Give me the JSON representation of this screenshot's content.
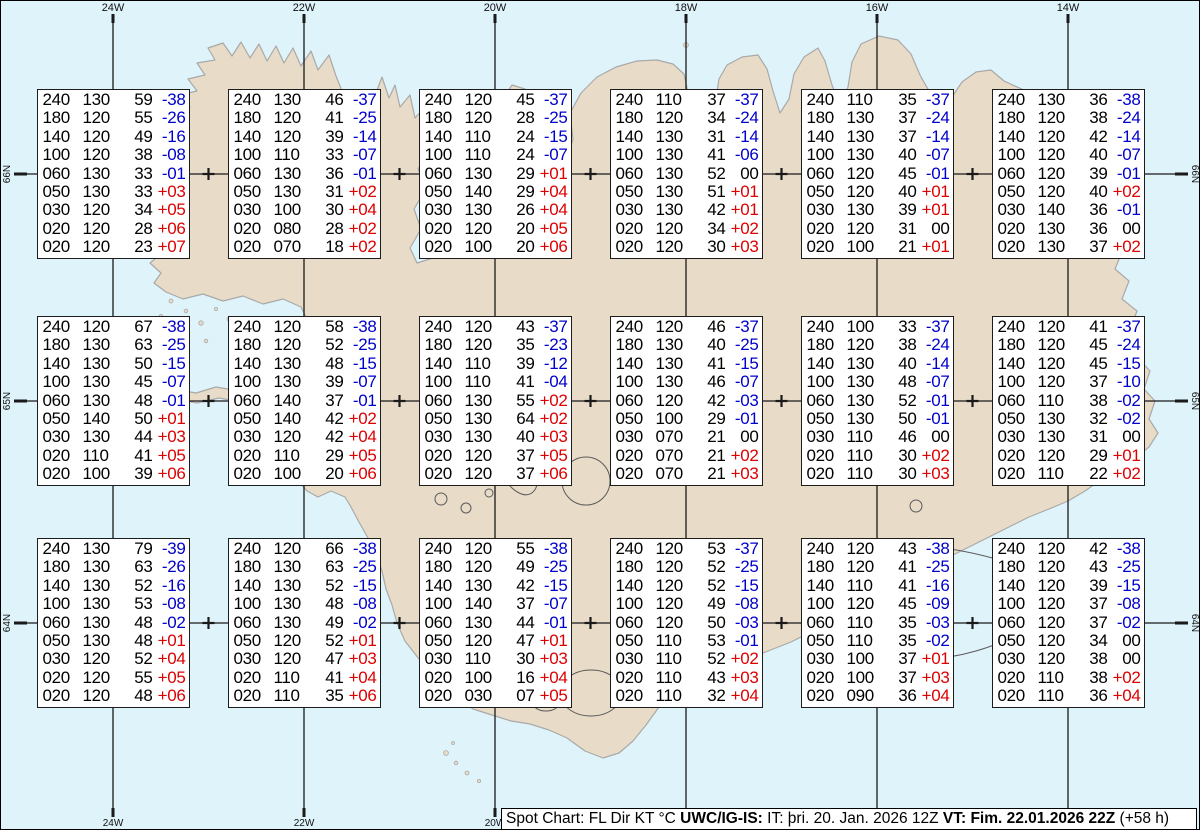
{
  "map": {
    "lon_labels": [
      "24W",
      "22W",
      "20W",
      "18W",
      "16W",
      "14W"
    ],
    "lat_labels": [
      "66N",
      "65N",
      "64N"
    ]
  },
  "colors": {
    "ocean": "#dff3fa",
    "land": "#e8dcc8",
    "coastline": "#a9a9a9",
    "contour": "#5a5a5a",
    "grid": "#1a1a1a",
    "temp_negative": "#0000cc",
    "temp_positive": "#dd0000",
    "temp_zero": "#000000"
  },
  "legend": {
    "segments": [
      {
        "text": "Spot Chart: FL Dir KT °C ",
        "bold": false
      },
      {
        "text": "UWC/IG-IS:",
        "bold": true
      },
      {
        "text": " IT: þri. 20. Jan. 2026 12Z ",
        "bold": false
      },
      {
        "text": "VT: Fim. 22.01.2026 22Z",
        "bold": true
      },
      {
        "text": " (+58 h)",
        "bold": false
      }
    ]
  },
  "stations": [
    {
      "id": "r1c1",
      "rows": [
        [
          "240",
          "130",
          "59",
          "-38"
        ],
        [
          "180",
          "120",
          "55",
          "-26"
        ],
        [
          "140",
          "120",
          "49",
          "-16"
        ],
        [
          "100",
          "120",
          "38",
          "-08"
        ],
        [
          "060",
          "130",
          "33",
          "-01"
        ],
        [
          "050",
          "130",
          "33",
          "+03"
        ],
        [
          "030",
          "120",
          "34",
          "+05"
        ],
        [
          "020",
          "120",
          "28",
          "+06"
        ],
        [
          "020",
          "120",
          "23",
          "+07"
        ]
      ]
    },
    {
      "id": "r1c2",
      "rows": [
        [
          "240",
          "130",
          "46",
          "-37"
        ],
        [
          "180",
          "120",
          "41",
          "-25"
        ],
        [
          "140",
          "120",
          "39",
          "-14"
        ],
        [
          "100",
          "110",
          "33",
          "-07"
        ],
        [
          "060",
          "130",
          "36",
          "-01"
        ],
        [
          "050",
          "130",
          "31",
          "+02"
        ],
        [
          "030",
          "100",
          "30",
          "+04"
        ],
        [
          "020",
          "080",
          "28",
          "+02"
        ],
        [
          "020",
          "070",
          "18",
          "+02"
        ]
      ]
    },
    {
      "id": "r1c3",
      "rows": [
        [
          "240",
          "120",
          "45",
          "-37"
        ],
        [
          "180",
          "120",
          "28",
          "-25"
        ],
        [
          "140",
          "110",
          "24",
          "-15"
        ],
        [
          "100",
          "110",
          "24",
          "-07"
        ],
        [
          "060",
          "130",
          "29",
          "+01"
        ],
        [
          "050",
          "140",
          "29",
          "+04"
        ],
        [
          "030",
          "130",
          "26",
          "+04"
        ],
        [
          "020",
          "120",
          "20",
          "+05"
        ],
        [
          "020",
          "100",
          "20",
          "+06"
        ]
      ]
    },
    {
      "id": "r1c4",
      "rows": [
        [
          "240",
          "110",
          "37",
          "-37"
        ],
        [
          "180",
          "120",
          "34",
          "-24"
        ],
        [
          "140",
          "130",
          "31",
          "-14"
        ],
        [
          "100",
          "130",
          "41",
          "-06"
        ],
        [
          "060",
          "130",
          "52",
          "00"
        ],
        [
          "050",
          "130",
          "51",
          "+01"
        ],
        [
          "030",
          "130",
          "42",
          "+01"
        ],
        [
          "020",
          "120",
          "34",
          "+02"
        ],
        [
          "020",
          "120",
          "30",
          "+03"
        ]
      ]
    },
    {
      "id": "r1c5",
      "rows": [
        [
          "240",
          "110",
          "35",
          "-37"
        ],
        [
          "180",
          "130",
          "37",
          "-24"
        ],
        [
          "140",
          "130",
          "37",
          "-14"
        ],
        [
          "100",
          "130",
          "40",
          "-07"
        ],
        [
          "060",
          "120",
          "45",
          "-01"
        ],
        [
          "050",
          "120",
          "40",
          "+01"
        ],
        [
          "030",
          "130",
          "39",
          "+01"
        ],
        [
          "020",
          "120",
          "31",
          "00"
        ],
        [
          "020",
          "100",
          "21",
          "+01"
        ]
      ]
    },
    {
      "id": "r1c6",
      "rows": [
        [
          "240",
          "130",
          "36",
          "-38"
        ],
        [
          "180",
          "120",
          "38",
          "-24"
        ],
        [
          "140",
          "120",
          "42",
          "-14"
        ],
        [
          "100",
          "120",
          "40",
          "-07"
        ],
        [
          "060",
          "120",
          "39",
          "-01"
        ],
        [
          "050",
          "120",
          "40",
          "+02"
        ],
        [
          "030",
          "140",
          "36",
          "-01"
        ],
        [
          "020",
          "130",
          "36",
          "00"
        ],
        [
          "020",
          "130",
          "37",
          "+02"
        ]
      ]
    },
    {
      "id": "r2c1",
      "rows": [
        [
          "240",
          "120",
          "67",
          "-38"
        ],
        [
          "180",
          "130",
          "63",
          "-25"
        ],
        [
          "140",
          "130",
          "50",
          "-15"
        ],
        [
          "100",
          "130",
          "45",
          "-07"
        ],
        [
          "060",
          "130",
          "48",
          "-01"
        ],
        [
          "050",
          "140",
          "50",
          "+01"
        ],
        [
          "030",
          "130",
          "44",
          "+03"
        ],
        [
          "020",
          "110",
          "41",
          "+05"
        ],
        [
          "020",
          "100",
          "39",
          "+06"
        ]
      ]
    },
    {
      "id": "r2c2",
      "rows": [
        [
          "240",
          "120",
          "58",
          "-38"
        ],
        [
          "180",
          "120",
          "52",
          "-25"
        ],
        [
          "140",
          "130",
          "48",
          "-15"
        ],
        [
          "100",
          "130",
          "39",
          "-07"
        ],
        [
          "060",
          "140",
          "37",
          "-01"
        ],
        [
          "050",
          "140",
          "42",
          "+02"
        ],
        [
          "030",
          "120",
          "42",
          "+04"
        ],
        [
          "020",
          "110",
          "29",
          "+05"
        ],
        [
          "020",
          "100",
          "20",
          "+06"
        ]
      ]
    },
    {
      "id": "r2c3",
      "rows": [
        [
          "240",
          "120",
          "43",
          "-37"
        ],
        [
          "180",
          "120",
          "35",
          "-23"
        ],
        [
          "140",
          "110",
          "39",
          "-12"
        ],
        [
          "100",
          "110",
          "41",
          "-04"
        ],
        [
          "060",
          "130",
          "55",
          "+02"
        ],
        [
          "050",
          "130",
          "64",
          "+02"
        ],
        [
          "030",
          "130",
          "40",
          "+03"
        ],
        [
          "020",
          "120",
          "37",
          "+05"
        ],
        [
          "020",
          "120",
          "37",
          "+06"
        ]
      ]
    },
    {
      "id": "r2c4",
      "rows": [
        [
          "240",
          "120",
          "46",
          "-37"
        ],
        [
          "180",
          "130",
          "40",
          "-25"
        ],
        [
          "140",
          "130",
          "41",
          "-15"
        ],
        [
          "100",
          "130",
          "46",
          "-07"
        ],
        [
          "060",
          "120",
          "42",
          "-03"
        ],
        [
          "050",
          "100",
          "29",
          "-01"
        ],
        [
          "030",
          "070",
          "21",
          "00"
        ],
        [
          "020",
          "070",
          "21",
          "+02"
        ],
        [
          "020",
          "070",
          "21",
          "+03"
        ]
      ]
    },
    {
      "id": "r2c5",
      "rows": [
        [
          "240",
          "100",
          "33",
          "-37"
        ],
        [
          "180",
          "120",
          "38",
          "-24"
        ],
        [
          "140",
          "130",
          "40",
          "-14"
        ],
        [
          "100",
          "130",
          "48",
          "-07"
        ],
        [
          "060",
          "130",
          "52",
          "-01"
        ],
        [
          "050",
          "130",
          "50",
          "-01"
        ],
        [
          "030",
          "110",
          "46",
          "00"
        ],
        [
          "020",
          "110",
          "30",
          "+02"
        ],
        [
          "020",
          "110",
          "30",
          "+03"
        ]
      ]
    },
    {
      "id": "r2c6",
      "rows": [
        [
          "240",
          "120",
          "41",
          "-37"
        ],
        [
          "180",
          "120",
          "45",
          "-24"
        ],
        [
          "140",
          "120",
          "45",
          "-15"
        ],
        [
          "100",
          "120",
          "37",
          "-10"
        ],
        [
          "060",
          "110",
          "38",
          "-02"
        ],
        [
          "050",
          "130",
          "32",
          "-02"
        ],
        [
          "030",
          "130",
          "31",
          "00"
        ],
        [
          "020",
          "120",
          "29",
          "+01"
        ],
        [
          "020",
          "110",
          "22",
          "+02"
        ]
      ]
    },
    {
      "id": "r3c1",
      "rows": [
        [
          "240",
          "130",
          "79",
          "-39"
        ],
        [
          "180",
          "130",
          "63",
          "-26"
        ],
        [
          "140",
          "130",
          "52",
          "-16"
        ],
        [
          "100",
          "130",
          "53",
          "-08"
        ],
        [
          "060",
          "130",
          "48",
          "-02"
        ],
        [
          "050",
          "130",
          "48",
          "+01"
        ],
        [
          "030",
          "120",
          "52",
          "+04"
        ],
        [
          "020",
          "120",
          "55",
          "+05"
        ],
        [
          "020",
          "120",
          "48",
          "+06"
        ]
      ]
    },
    {
      "id": "r3c2",
      "rows": [
        [
          "240",
          "120",
          "66",
          "-38"
        ],
        [
          "180",
          "130",
          "63",
          "-25"
        ],
        [
          "140",
          "130",
          "52",
          "-15"
        ],
        [
          "100",
          "130",
          "48",
          "-08"
        ],
        [
          "060",
          "130",
          "49",
          "-02"
        ],
        [
          "050",
          "120",
          "52",
          "+01"
        ],
        [
          "030",
          "120",
          "47",
          "+03"
        ],
        [
          "020",
          "110",
          "41",
          "+04"
        ],
        [
          "020",
          "110",
          "35",
          "+06"
        ]
      ]
    },
    {
      "id": "r3c3",
      "rows": [
        [
          "240",
          "120",
          "55",
          "-38"
        ],
        [
          "180",
          "120",
          "49",
          "-25"
        ],
        [
          "140",
          "130",
          "42",
          "-15"
        ],
        [
          "100",
          "140",
          "37",
          "-07"
        ],
        [
          "060",
          "130",
          "44",
          "-01"
        ],
        [
          "050",
          "120",
          "47",
          "+01"
        ],
        [
          "030",
          "110",
          "30",
          "+03"
        ],
        [
          "020",
          "100",
          "16",
          "+04"
        ],
        [
          "020",
          "030",
          "07",
          "+05"
        ]
      ]
    },
    {
      "id": "r3c4",
      "rows": [
        [
          "240",
          "120",
          "53",
          "-37"
        ],
        [
          "180",
          "120",
          "52",
          "-25"
        ],
        [
          "140",
          "120",
          "52",
          "-15"
        ],
        [
          "100",
          "120",
          "49",
          "-08"
        ],
        [
          "060",
          "120",
          "50",
          "-03"
        ],
        [
          "050",
          "110",
          "53",
          "-01"
        ],
        [
          "030",
          "110",
          "52",
          "+02"
        ],
        [
          "020",
          "110",
          "43",
          "+03"
        ],
        [
          "020",
          "110",
          "32",
          "+04"
        ]
      ]
    },
    {
      "id": "r3c5",
      "rows": [
        [
          "240",
          "120",
          "43",
          "-38"
        ],
        [
          "180",
          "120",
          "41",
          "-25"
        ],
        [
          "140",
          "110",
          "41",
          "-16"
        ],
        [
          "100",
          "120",
          "45",
          "-09"
        ],
        [
          "060",
          "110",
          "35",
          "-03"
        ],
        [
          "050",
          "110",
          "35",
          "-02"
        ],
        [
          "030",
          "100",
          "37",
          "+01"
        ],
        [
          "020",
          "100",
          "37",
          "+03"
        ],
        [
          "020",
          "090",
          "36",
          "+04"
        ]
      ]
    },
    {
      "id": "r3c6",
      "rows": [
        [
          "240",
          "120",
          "42",
          "-38"
        ],
        [
          "180",
          "120",
          "43",
          "-25"
        ],
        [
          "140",
          "120",
          "39",
          "-15"
        ],
        [
          "100",
          "120",
          "37",
          "-08"
        ],
        [
          "060",
          "120",
          "37",
          "-02"
        ],
        [
          "050",
          "120",
          "34",
          "00"
        ],
        [
          "030",
          "120",
          "38",
          "00"
        ],
        [
          "020",
          "110",
          "38",
          "+02"
        ],
        [
          "020",
          "110",
          "36",
          "+04"
        ]
      ]
    }
  ]
}
